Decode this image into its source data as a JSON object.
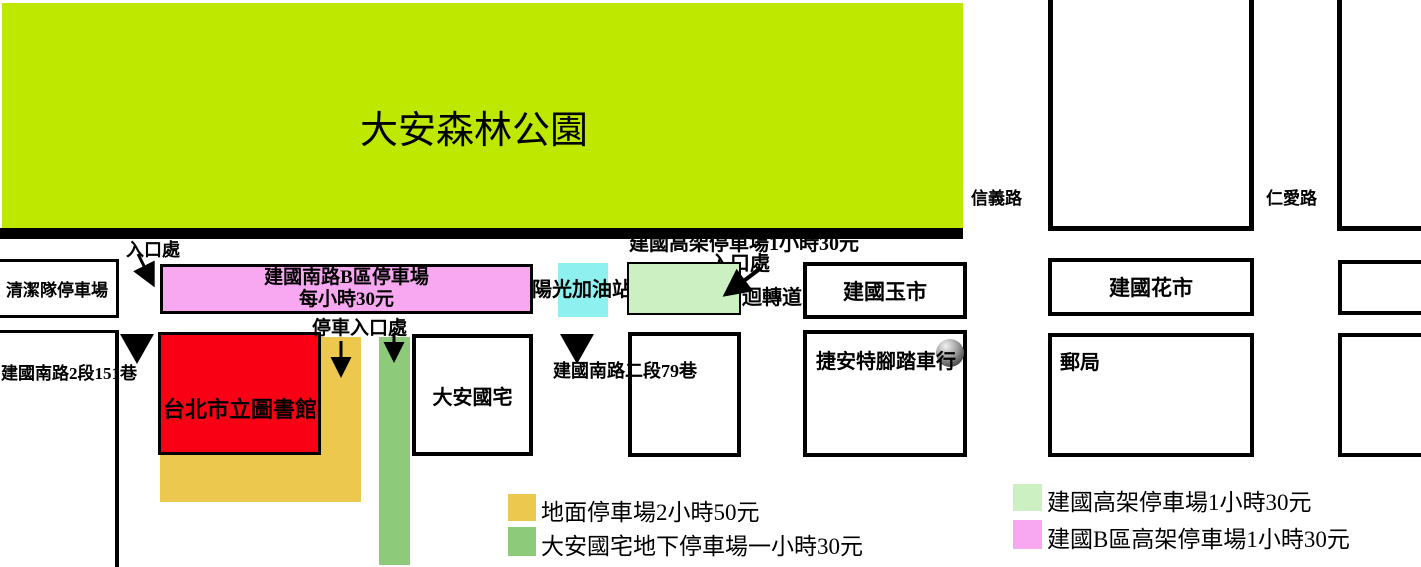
{
  "park": {
    "label": "大安森林公園"
  },
  "roads": {
    "xinyi": "信義路",
    "renai": "仁愛路",
    "jianguo_lane151": "建國南路2段151巷",
    "jianguo_lane79": "建國南路二段79巷"
  },
  "annotations": {
    "entrance_b_lot": "入口處",
    "entrance_elevated": "入口處",
    "elevated_price_note": "建國高架停車場1小時30元",
    "parking_entrance": "停車入口處",
    "u_turn": "迴轉道"
  },
  "places": {
    "cleaning_team_lot": "清潔隊停車場",
    "b_lot_name": "建國南路B區停車場",
    "b_lot_price": "每小時30元",
    "gas_station": "陽光加油站",
    "jade_market": "建國玉市",
    "flower_market": "建國花市",
    "library": "台北市立圖書館",
    "daan_housing": "大安國宅",
    "bike_shop": "捷安特腳踏車行",
    "post_office": "郵局"
  },
  "legend": {
    "items": [
      {
        "color": "#ecc84e",
        "label": "地面停車場2小時50元"
      },
      {
        "color": "#8dcb7b",
        "label": "大安國宅地下停車場一小時30元"
      },
      {
        "color": "#cdf0c2",
        "label": "建國高架停車場1小時30元"
      },
      {
        "color": "#f7a8f0",
        "label": "建國B區高架停車場1小時30元"
      }
    ]
  },
  "colors": {
    "park_green": "#bee800",
    "b_lot_pink": "#f7a8f0",
    "gas_cyan": "#8ff0f0",
    "elevated_light_green": "#cdf0c2",
    "library_red": "#f90014",
    "surface_lot_yellow": "#ecc84e",
    "underground_lot_green": "#8dcb7b",
    "road_black": "#000000"
  }
}
